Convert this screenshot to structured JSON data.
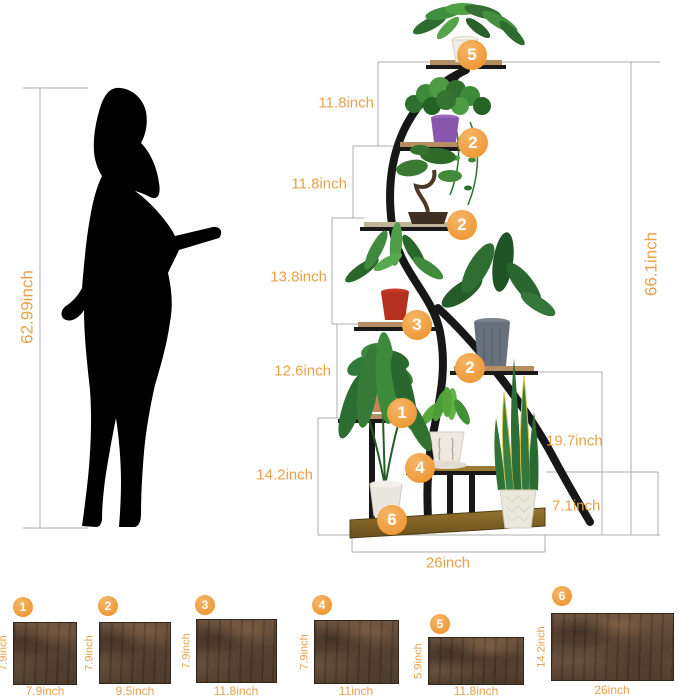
{
  "person": {
    "height_label": "62.99inch"
  },
  "stand": {
    "total_height_label": "66.1inch",
    "base_width_label": "26inch",
    "left_gaps": [
      "11.8inch",
      "11.8inch",
      "13.8inch",
      "12.6inch",
      "14.2inch"
    ],
    "right_gaps": [
      "19.7inch",
      "7.1inch"
    ],
    "shelf_markers": [
      "5",
      "2",
      "2",
      "3",
      "2",
      "1",
      "4",
      "6"
    ]
  },
  "panels": [
    {
      "marker": "1",
      "side_label": "7.9inch",
      "bottom_label": "7.9inch"
    },
    {
      "marker": "2",
      "side_label": "7.9inch",
      "bottom_label": "9.5inch"
    },
    {
      "marker": "3",
      "side_label": "7.9inch",
      "bottom_label": "11.8inch"
    },
    {
      "marker": "4",
      "side_label": "7.9inch",
      "bottom_label": "11inch"
    },
    {
      "marker": "5",
      "side_label": "5.9inch",
      "bottom_label": "11.8inch"
    },
    {
      "marker": "6",
      "side_label": "14.2inch",
      "bottom_label": "26inch"
    }
  ],
  "colors": {
    "accent_text": "#E8A14C",
    "marker_fill": "#F0A143",
    "dimension_line": "#ACACAC",
    "silhouette": "#000000"
  }
}
